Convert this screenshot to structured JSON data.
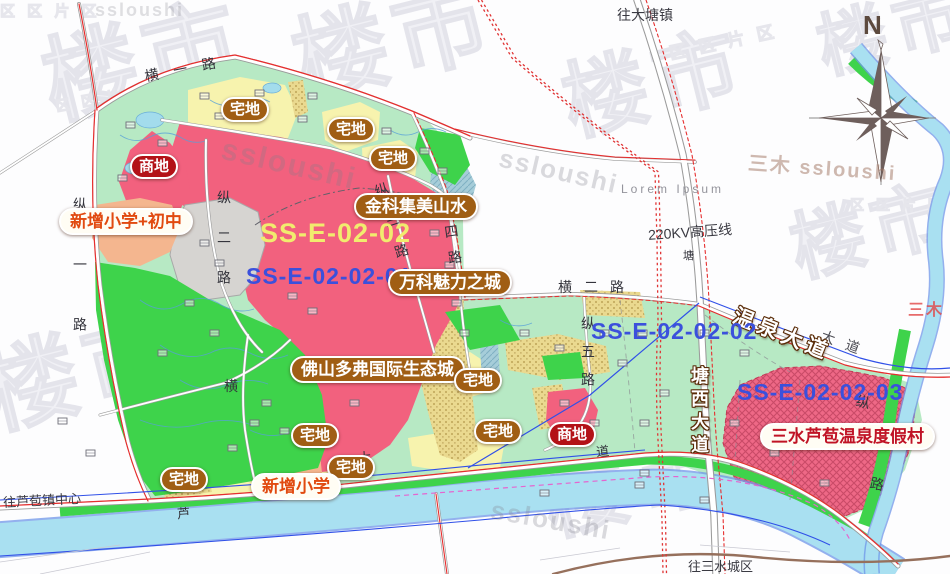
{
  "map": {
    "zone_codes": {
      "main": "SS-E-02-02",
      "sub_01": "SS-E-02-02-01",
      "sub_02": "SS-E-02-02-02",
      "sub_03": "SS-E-02-02-03"
    },
    "badges": {
      "zhaidi": "宅地",
      "shangdi": "商地",
      "school_combo": "新增小学+初中",
      "school_primary": "新增小学",
      "jinke": "金科集美山水",
      "vanke": "万科魅力之城",
      "duofu": "佛山多弗国际生态城",
      "resort": "三水芦苞温泉度假村"
    },
    "roads": {
      "heng1": "横一路",
      "heng2": "横二路",
      "heng_mid": "横",
      "zong1": "纵一路",
      "zong2": "纵二路",
      "zong3": "纵三路",
      "zong4": "四路",
      "zong5": "纵五路",
      "zong6_char1": "纵",
      "zong6_char2": "路",
      "wenquan": "温泉大道",
      "tangxi": "塘西大道",
      "dadao": "大道",
      "river_road_1": "芦",
      "river_road_2": "大",
      "river_road_3": "道",
      "tang": "塘"
    },
    "directions": {
      "to_datang": "往大塘镇",
      "to_lubao": "往芦苞镇中心",
      "to_sanshui": "往三水城区"
    },
    "annotations": {
      "powerline": "220KV高压线",
      "lorem": "Lorem Ipsum"
    },
    "compass": {
      "north": "N"
    },
    "watermarks": {
      "brand": "ssloushi",
      "brand_combo": "三木  ssloushi",
      "brand_cn": "三木",
      "glyph": "楼市",
      "tiles": "区 区 片 区"
    },
    "colors": {
      "pink_zone": "#f2617e",
      "resort_zone": "#ee6886",
      "yellow_zone": "#f7f3ae",
      "khaki_zone": "#ead98f",
      "mint_zone": "#b7e9c4",
      "green_zone": "#3ed34b",
      "river": "#a9e0f1",
      "village_gray": "#d6d4d1",
      "school_salmon": "#f4b68f",
      "badge_brown": "#a05e14",
      "badge_red": "#b31217",
      "label_yellow": "#f1ec6e",
      "label_blue": "#3b50dc",
      "road_red_line": "#e62e2e"
    }
  }
}
